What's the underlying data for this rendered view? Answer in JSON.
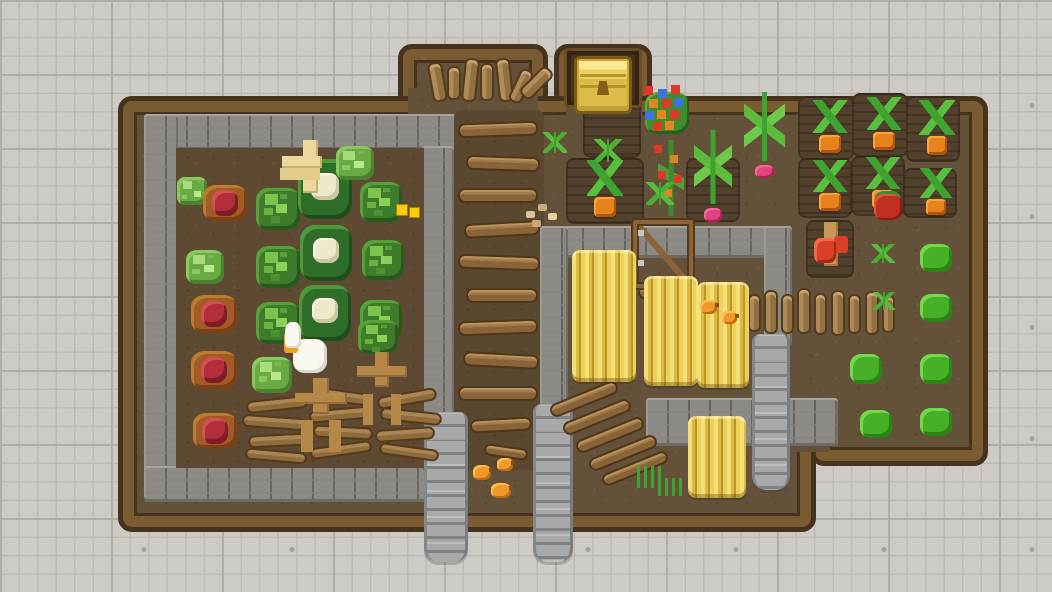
{
  "scene": {
    "description": "Top-down pixel-art farm: walled cabbage garden, gold chest alcove, wheat pens with stone walls and wooden gate, carrot and radish plots, plank and stone paths, goose, farmers, chicks and gnome on a gray tiled floor",
    "width": 1052,
    "height": 592,
    "palette": {
      "tile_background": "#cecbc6",
      "tile_grid_line": "#bdbab4",
      "dirt": "#64513a",
      "tilled_soil": "#50402c",
      "wood_border": "#7b5b31",
      "wood_border_outline": "#46331d",
      "stone_wall": "#8b8a85",
      "stone_path": "#a8a9ab",
      "plank_wood": "#8a6438",
      "log_wood": "#b08a58",
      "wheat_gold": "#ecd058",
      "cabbage_green": "#3e7c2c",
      "cabbage_light_green": "#6aaa42",
      "cauliflower_cream": "#eee8cc",
      "red_cabbage": "#b22e3c",
      "carrot_orange": "#e8821c",
      "radish_pink": "#e0437e",
      "bush_green": "#46b027",
      "flower_red": "#e03828",
      "flower_blue": "#3c74e0",
      "flower_orange": "#e08424",
      "chest_gold": "#ecd060",
      "goose_white": "#f8f8f0",
      "farmer_tan": "#b5884a",
      "chick_orange": "#f09828",
      "gnome_red": "#d84028",
      "gold_nugget": "#f8cc08"
    },
    "entities": [
      {
        "type": "farm-block",
        "x": 398,
        "y": 44,
        "w": 150,
        "h": 64
      },
      {
        "type": "farm-block",
        "x": 554,
        "y": 44,
        "w": 98,
        "h": 64
      },
      {
        "type": "farm-block",
        "x": 810,
        "y": 96,
        "w": 178,
        "h": 370
      },
      {
        "type": "farm-block",
        "x": 118,
        "y": 96,
        "w": 698,
        "h": 436
      },
      {
        "type": "dirt-patch",
        "v": "plain",
        "x": 408,
        "y": 88,
        "w": 130,
        "h": 34
      },
      {
        "type": "dirt-patch",
        "v": "plain",
        "x": 566,
        "y": 88,
        "w": 76,
        "h": 34
      },
      {
        "type": "dirt-patch",
        "v": "plain",
        "x": 796,
        "y": 114,
        "w": 34,
        "h": 338
      },
      {
        "type": "stone-wall",
        "x": 144,
        "y": 114,
        "w": 312,
        "h": 36
      },
      {
        "type": "stone-wall",
        "x": 144,
        "y": 114,
        "w": 34,
        "h": 388
      },
      {
        "type": "stone-wall",
        "x": 144,
        "y": 466,
        "w": 312,
        "h": 36
      },
      {
        "type": "stone-wall",
        "x": 422,
        "y": 146,
        "w": 32,
        "h": 324
      },
      {
        "type": "dirt-patch",
        "v": "dark2",
        "x": 176,
        "y": 148,
        "w": 248,
        "h": 320
      },
      {
        "type": "dirt-patch",
        "v": "dark",
        "x": 454,
        "y": 110,
        "w": 90,
        "h": 360
      },
      {
        "type": "stone-wall",
        "x": 540,
        "y": 226,
        "w": 252,
        "h": 32
      },
      {
        "type": "stone-wall",
        "x": 540,
        "y": 226,
        "w": 28,
        "h": 182
      },
      {
        "type": "stone-wall",
        "x": 764,
        "y": 226,
        "w": 28,
        "h": 120
      },
      {
        "type": "stone-wall",
        "x": 646,
        "y": 398,
        "w": 192,
        "h": 48
      },
      {
        "type": "stone-path",
        "x": 424,
        "y": 412,
        "w": 44,
        "h": 150
      },
      {
        "type": "stone-path",
        "x": 533,
        "y": 404,
        "w": 40,
        "h": 158
      },
      {
        "type": "stone-path",
        "x": 752,
        "y": 334,
        "w": 38,
        "h": 156
      },
      {
        "type": "dirt-patch",
        "v": "tilled",
        "x": 583,
        "y": 90,
        "w": 58,
        "h": 68
      },
      {
        "type": "dirt-patch",
        "v": "tilled",
        "x": 566,
        "y": 158,
        "w": 78,
        "h": 66
      },
      {
        "type": "dirt-patch",
        "v": "tilled",
        "x": 686,
        "y": 158,
        "w": 54,
        "h": 64
      },
      {
        "type": "dirt-patch",
        "v": "tilled",
        "x": 798,
        "y": 96,
        "w": 56,
        "h": 64
      },
      {
        "type": "dirt-patch",
        "v": "tilled",
        "x": 852,
        "y": 93,
        "w": 56,
        "h": 64
      },
      {
        "type": "dirt-patch",
        "v": "tilled",
        "x": 906,
        "y": 96,
        "w": 54,
        "h": 66
      },
      {
        "type": "dirt-patch",
        "v": "tilled",
        "x": 798,
        "y": 158,
        "w": 54,
        "h": 60
      },
      {
        "type": "dirt-patch",
        "v": "tilled",
        "x": 851,
        "y": 156,
        "w": 54,
        "h": 60
      },
      {
        "type": "dirt-patch",
        "v": "tilled",
        "x": 903,
        "y": 168,
        "w": 54,
        "h": 50
      },
      {
        "type": "dirt-patch",
        "v": "tilled",
        "x": 806,
        "y": 220,
        "w": 48,
        "h": 58
      },
      {
        "type": "chest-alcove",
        "x": 564,
        "y": 48,
        "w": 78,
        "h": 60
      },
      {
        "type": "chest",
        "x": 574,
        "y": 56,
        "w": 58,
        "h": 58
      },
      {
        "type": "log",
        "x": 430,
        "y": 62,
        "w": 15,
        "h": 40,
        "r": -10
      },
      {
        "type": "log",
        "x": 447,
        "y": 66,
        "w": 14,
        "h": 34
      },
      {
        "type": "log",
        "x": 463,
        "y": 58,
        "w": 15,
        "h": 44,
        "r": 6
      },
      {
        "type": "log",
        "x": 480,
        "y": 63,
        "w": 14,
        "h": 38
      },
      {
        "type": "log",
        "x": 497,
        "y": 58,
        "w": 15,
        "h": 44,
        "r": -6
      },
      {
        "type": "log",
        "x": 514,
        "y": 68,
        "w": 14,
        "h": 36,
        "r": 25
      },
      {
        "type": "log",
        "x": 529,
        "y": 64,
        "w": 15,
        "h": 38,
        "r": 45
      },
      {
        "type": "plank",
        "x": 458,
        "y": 122,
        "w": 80,
        "h": 15,
        "r": -2
      },
      {
        "type": "plank",
        "x": 466,
        "y": 156,
        "w": 74,
        "h": 15,
        "r": 2
      },
      {
        "type": "plank",
        "x": 458,
        "y": 188,
        "w": 80,
        "h": 15
      },
      {
        "type": "plank",
        "x": 464,
        "y": 222,
        "w": 76,
        "h": 15,
        "r": -3
      },
      {
        "type": "plank",
        "x": 458,
        "y": 255,
        "w": 82,
        "h": 15,
        "r": 2
      },
      {
        "type": "plank",
        "x": 466,
        "y": 288,
        "w": 72,
        "h": 15
      },
      {
        "type": "plank",
        "x": 458,
        "y": 320,
        "w": 80,
        "h": 15,
        "r": -2
      },
      {
        "type": "plank",
        "x": 463,
        "y": 353,
        "w": 76,
        "h": 15,
        "r": 3
      },
      {
        "type": "plank",
        "x": 458,
        "y": 386,
        "w": 80,
        "h": 15
      },
      {
        "type": "plank",
        "x": 470,
        "y": 418,
        "w": 62,
        "h": 14,
        "r": -3
      },
      {
        "type": "plank",
        "x": 484,
        "y": 446,
        "w": 44,
        "h": 12,
        "r": 8
      },
      {
        "type": "log",
        "x": 748,
        "y": 294,
        "w": 13,
        "h": 38
      },
      {
        "type": "log",
        "x": 764,
        "y": 290,
        "w": 14,
        "h": 44
      },
      {
        "type": "log",
        "x": 781,
        "y": 294,
        "w": 13,
        "h": 40
      },
      {
        "type": "log",
        "x": 797,
        "y": 288,
        "w": 14,
        "h": 46
      },
      {
        "type": "log",
        "x": 814,
        "y": 293,
        "w": 13,
        "h": 42
      },
      {
        "type": "log",
        "x": 831,
        "y": 290,
        "w": 14,
        "h": 46
      },
      {
        "type": "log",
        "x": 848,
        "y": 294,
        "w": 13,
        "h": 40
      },
      {
        "type": "log",
        "x": 865,
        "y": 291,
        "w": 14,
        "h": 44
      },
      {
        "type": "log",
        "x": 882,
        "y": 295,
        "w": 13,
        "h": 38
      },
      {
        "type": "log-h",
        "x": 246,
        "y": 398,
        "w": 62,
        "h": 13,
        "r": -6
      },
      {
        "type": "log-h",
        "x": 242,
        "y": 416,
        "w": 64,
        "h": 13,
        "r": 4
      },
      {
        "type": "log-h",
        "x": 248,
        "y": 434,
        "w": 60,
        "h": 13,
        "r": -3
      },
      {
        "type": "log-h",
        "x": 245,
        "y": 450,
        "w": 62,
        "h": 12,
        "r": 5
      },
      {
        "type": "log-h",
        "x": 312,
        "y": 390,
        "w": 60,
        "h": 13,
        "r": 8
      },
      {
        "type": "log-h",
        "x": 309,
        "y": 408,
        "w": 64,
        "h": 13,
        "r": -5
      },
      {
        "type": "log-h",
        "x": 313,
        "y": 426,
        "w": 60,
        "h": 13,
        "r": 3
      },
      {
        "type": "log-h",
        "x": 310,
        "y": 444,
        "w": 62,
        "h": 12,
        "r": -8
      },
      {
        "type": "log-h",
        "x": 377,
        "y": 392,
        "w": 60,
        "h": 13,
        "r": -10
      },
      {
        "type": "log-h",
        "x": 380,
        "y": 410,
        "w": 62,
        "h": 13,
        "r": 6
      },
      {
        "type": "log-h",
        "x": 375,
        "y": 428,
        "w": 60,
        "h": 13,
        "r": -4
      },
      {
        "type": "log-h",
        "x": 379,
        "y": 446,
        "w": 60,
        "h": 12,
        "r": 8
      },
      {
        "type": "plank",
        "x": 548,
        "y": 392,
        "w": 72,
        "h": 14,
        "r": -22
      },
      {
        "type": "plank",
        "x": 561,
        "y": 410,
        "w": 72,
        "h": 14,
        "r": -22
      },
      {
        "type": "plank",
        "x": 574,
        "y": 428,
        "w": 72,
        "h": 14,
        "r": -22
      },
      {
        "type": "plank",
        "x": 587,
        "y": 446,
        "w": 72,
        "h": 14,
        "r": -22
      },
      {
        "type": "plank",
        "x": 600,
        "y": 462,
        "w": 70,
        "h": 13,
        "r": -22
      },
      {
        "type": "plank",
        "x": 638,
        "y": 286,
        "w": 54,
        "h": 13
      },
      {
        "type": "gate",
        "x": 633,
        "y": 220,
        "w": 60,
        "h": 68
      },
      {
        "type": "cabbage-light",
        "x": 176,
        "y": 176,
        "w": 32,
        "h": 30
      },
      {
        "type": "red-cabbage",
        "x": 202,
        "y": 182,
        "w": 46,
        "h": 42
      },
      {
        "type": "cabbage",
        "x": 254,
        "y": 186,
        "w": 48,
        "h": 46
      },
      {
        "type": "cauliflower",
        "x": 296,
        "y": 158,
        "w": 58,
        "h": 62
      },
      {
        "type": "cabbage-light",
        "x": 334,
        "y": 144,
        "w": 42,
        "h": 38
      },
      {
        "type": "cabbage",
        "x": 358,
        "y": 180,
        "w": 46,
        "h": 44
      },
      {
        "type": "gold",
        "x": 396,
        "y": 204,
        "w": 24,
        "h": 14
      },
      {
        "type": "cabbage-light",
        "x": 184,
        "y": 248,
        "w": 42,
        "h": 38
      },
      {
        "type": "cabbage",
        "x": 254,
        "y": 244,
        "w": 48,
        "h": 46
      },
      {
        "type": "cauliflower",
        "x": 298,
        "y": 224,
        "w": 56,
        "h": 58
      },
      {
        "type": "cabbage",
        "x": 360,
        "y": 238,
        "w": 46,
        "h": 44
      },
      {
        "type": "red-cabbage",
        "x": 190,
        "y": 292,
        "w": 48,
        "h": 44
      },
      {
        "type": "cabbage",
        "x": 254,
        "y": 300,
        "w": 48,
        "h": 46
      },
      {
        "type": "cauliflower",
        "x": 297,
        "y": 284,
        "w": 56,
        "h": 58
      },
      {
        "type": "cabbage",
        "x": 358,
        "y": 298,
        "w": 46,
        "h": 44
      },
      {
        "type": "red-cabbage",
        "x": 190,
        "y": 348,
        "w": 48,
        "h": 44
      },
      {
        "type": "cabbage-light",
        "x": 250,
        "y": 355,
        "w": 44,
        "h": 40
      },
      {
        "type": "cabbage",
        "x": 356,
        "y": 318,
        "w": 44,
        "h": 38
      },
      {
        "type": "red-cabbage",
        "x": 192,
        "y": 410,
        "w": 46,
        "h": 42
      },
      {
        "type": "scarecrow",
        "x": 282,
        "y": 140,
        "w": 56,
        "h": 60
      },
      {
        "type": "goose",
        "x": 284,
        "y": 322,
        "w": 52,
        "h": 58
      },
      {
        "type": "farmer",
        "x": 294,
        "y": 376,
        "w": 54,
        "h": 60
      },
      {
        "type": "farmer",
        "x": 356,
        "y": 350,
        "w": 52,
        "h": 58
      },
      {
        "type": "seedling",
        "x": 540,
        "y": 130,
        "w": 30,
        "h": 28
      },
      {
        "type": "seedling",
        "x": 590,
        "y": 136,
        "w": 36,
        "h": 32
      },
      {
        "type": "flowers",
        "x": 640,
        "y": 84,
        "w": 54,
        "h": 58
      },
      {
        "type": "flower-plant",
        "x": 650,
        "y": 140,
        "w": 42,
        "h": 76
      },
      {
        "type": "radish",
        "x": 688,
        "y": 130,
        "w": 50,
        "h": 92
      },
      {
        "type": "radish",
        "x": 737,
        "y": 92,
        "w": 55,
        "h": 86
      },
      {
        "type": "carrot",
        "x": 583,
        "y": 160,
        "w": 44,
        "h": 58
      },
      {
        "type": "seedling",
        "x": 643,
        "y": 180,
        "w": 34,
        "h": 30
      },
      {
        "type": "seeds",
        "x": 522,
        "y": 203,
        "w": 40,
        "h": 26
      },
      {
        "type": "wheat",
        "x": 572,
        "y": 250,
        "w": 64,
        "h": 132
      },
      {
        "type": "wheat",
        "x": 644,
        "y": 276,
        "w": 54,
        "h": 110
      },
      {
        "type": "wheat",
        "x": 697,
        "y": 282,
        "w": 52,
        "h": 106
      },
      {
        "type": "wheat",
        "x": 688,
        "y": 416,
        "w": 58,
        "h": 82
      },
      {
        "type": "chick",
        "x": 700,
        "y": 300,
        "w": 17,
        "h": 14
      },
      {
        "type": "chick",
        "x": 722,
        "y": 311,
        "w": 15,
        "h": 13
      },
      {
        "type": "chick",
        "x": 473,
        "y": 465,
        "w": 18,
        "h": 15
      },
      {
        "type": "chick",
        "x": 497,
        "y": 458,
        "w": 16,
        "h": 13
      },
      {
        "type": "chick",
        "x": 491,
        "y": 483,
        "w": 20,
        "h": 15
      },
      {
        "type": "grass",
        "x": 637,
        "y": 466,
        "w": 28,
        "h": 22
      },
      {
        "type": "grass",
        "x": 658,
        "y": 478,
        "w": 26,
        "h": 18
      },
      {
        "type": "carrot",
        "x": 808,
        "y": 100,
        "w": 44,
        "h": 54
      },
      {
        "type": "carrot",
        "x": 862,
        "y": 97,
        "w": 44,
        "h": 54
      },
      {
        "type": "carrot",
        "x": 916,
        "y": 100,
        "w": 42,
        "h": 56
      },
      {
        "type": "carrot",
        "x": 808,
        "y": 160,
        "w": 44,
        "h": 52
      },
      {
        "type": "carrot",
        "x": 861,
        "y": 157,
        "w": 44,
        "h": 52
      },
      {
        "type": "carrot",
        "x": 915,
        "y": 168,
        "w": 42,
        "h": 48
      },
      {
        "type": "gnome",
        "x": 812,
        "y": 222,
        "w": 40,
        "h": 48
      },
      {
        "type": "red-plant",
        "x": 874,
        "y": 194,
        "w": 28,
        "h": 26
      },
      {
        "type": "seedling",
        "x": 868,
        "y": 242,
        "w": 30,
        "h": 26
      },
      {
        "type": "bush",
        "x": 920,
        "y": 244,
        "w": 32,
        "h": 28
      },
      {
        "type": "seedling",
        "x": 870,
        "y": 290,
        "w": 28,
        "h": 24
      },
      {
        "type": "bush",
        "x": 920,
        "y": 294,
        "w": 32,
        "h": 28
      },
      {
        "type": "bush",
        "x": 850,
        "y": 354,
        "w": 32,
        "h": 30
      },
      {
        "type": "bush",
        "x": 920,
        "y": 354,
        "w": 32,
        "h": 30
      },
      {
        "type": "bush",
        "x": 860,
        "y": 410,
        "w": 32,
        "h": 28
      },
      {
        "type": "bush",
        "x": 920,
        "y": 408,
        "w": 32,
        "h": 28
      }
    ]
  }
}
